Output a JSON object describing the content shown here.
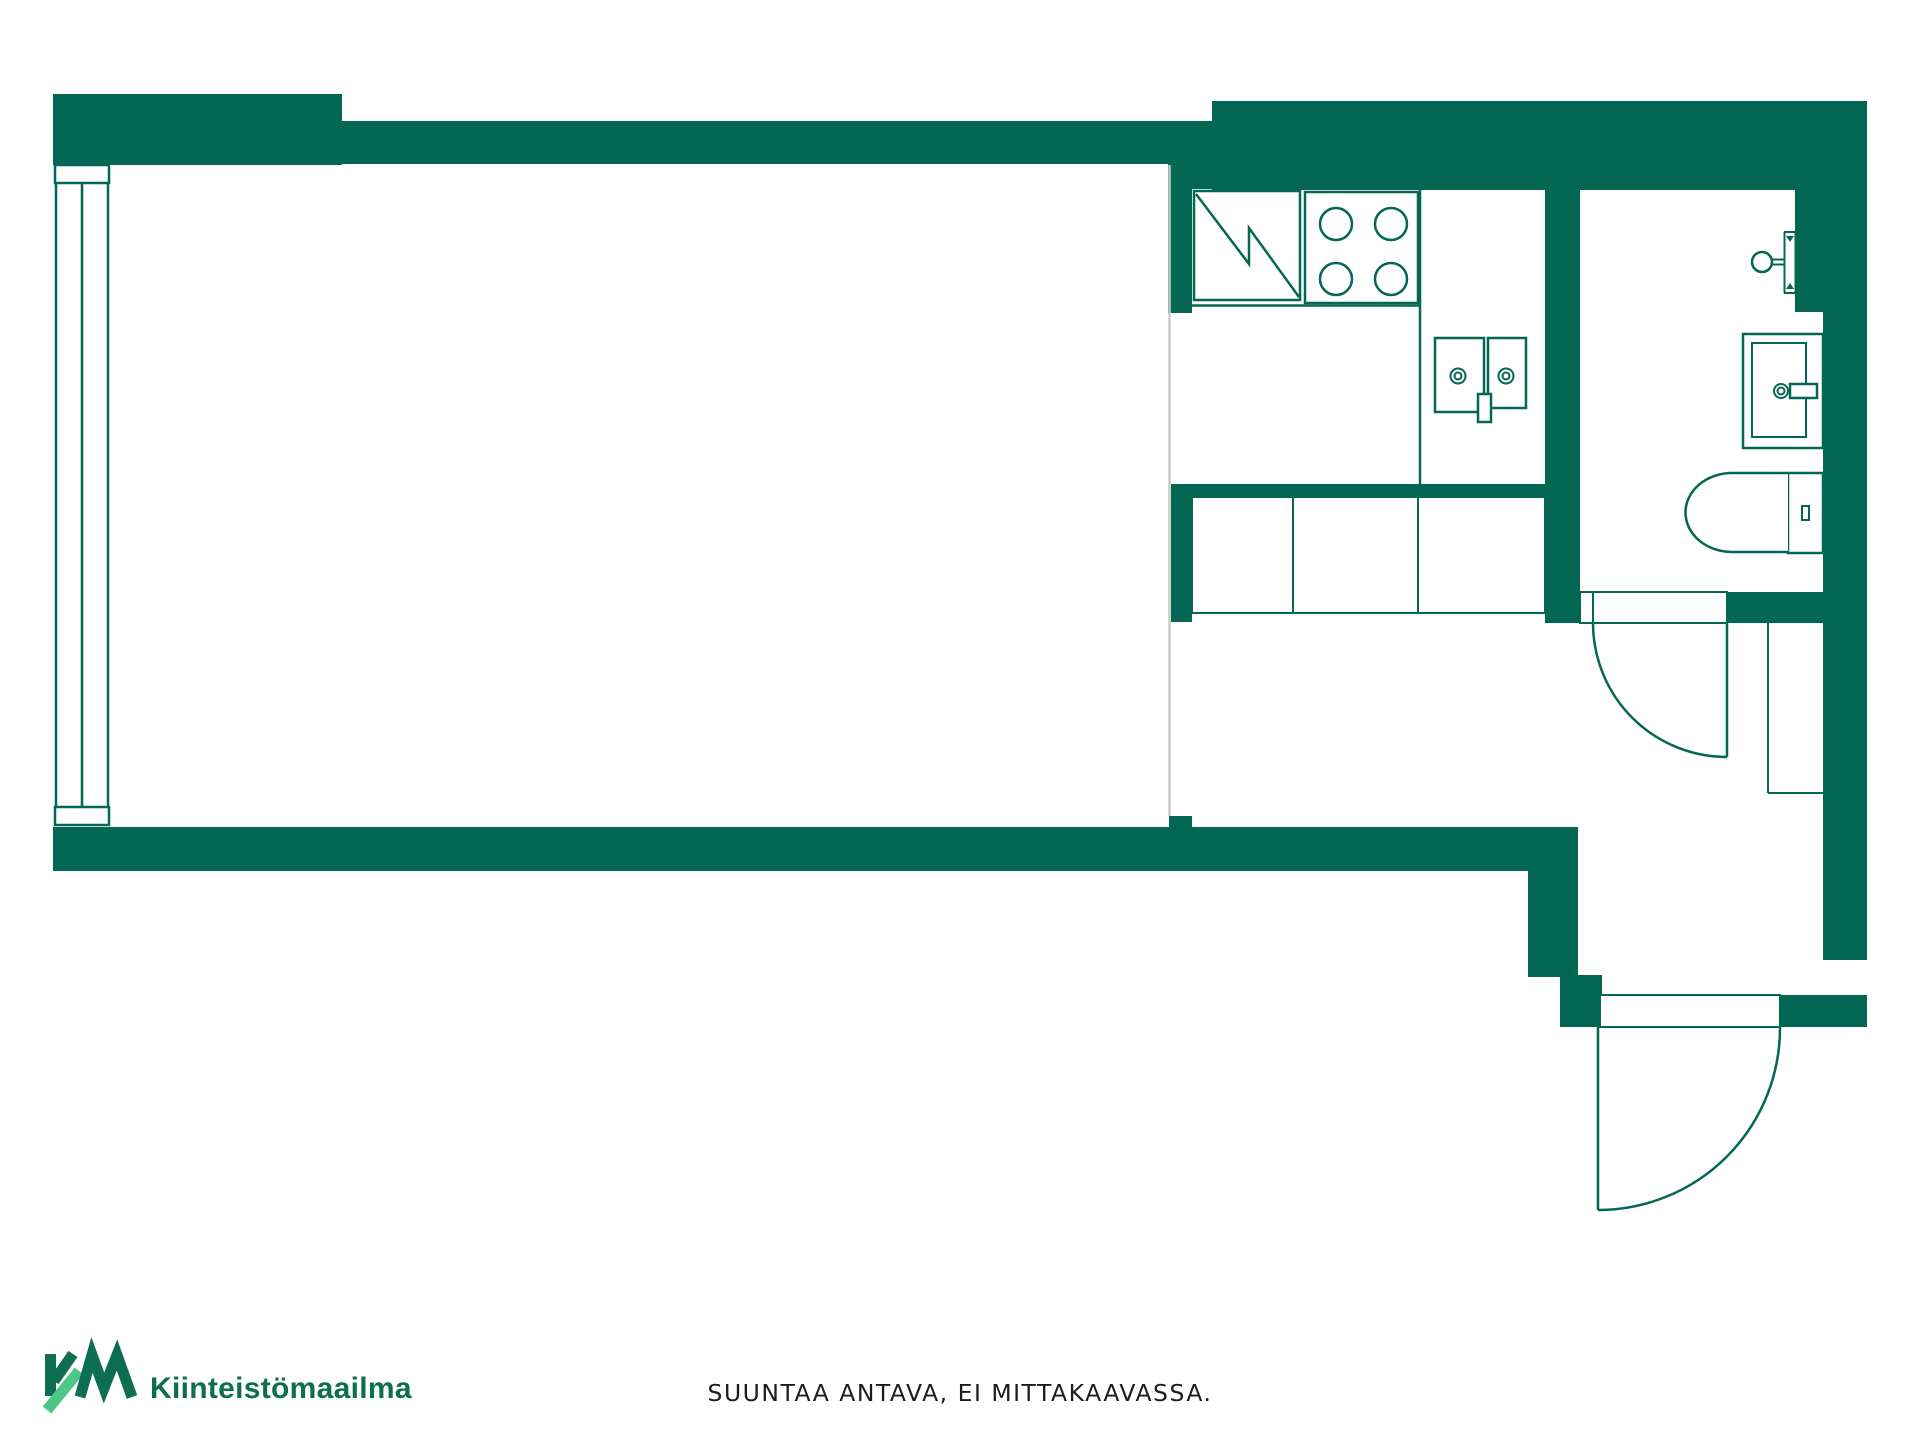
{
  "colors": {
    "background": "#ffffff",
    "wall_green": "#036754",
    "divider_gray": "#c8cbc9",
    "logo_dark_green": "#0d6e52",
    "logo_light_green": "#4dc688",
    "text_black": "#1c1c1c"
  },
  "floorplan": {
    "fixtures": [
      "window",
      "fridge",
      "stove",
      "kitchen-sink",
      "base-cabinets",
      "shower",
      "washbasin",
      "toilet",
      "wardrobe",
      "interior-door",
      "exterior-door"
    ]
  },
  "footer": {
    "logo_mark": "KM",
    "logo_text": "Kiinteistömaailma",
    "disclaimer": "SUUNTAA ANTAVA, EI MITTAKAAVASSA."
  }
}
